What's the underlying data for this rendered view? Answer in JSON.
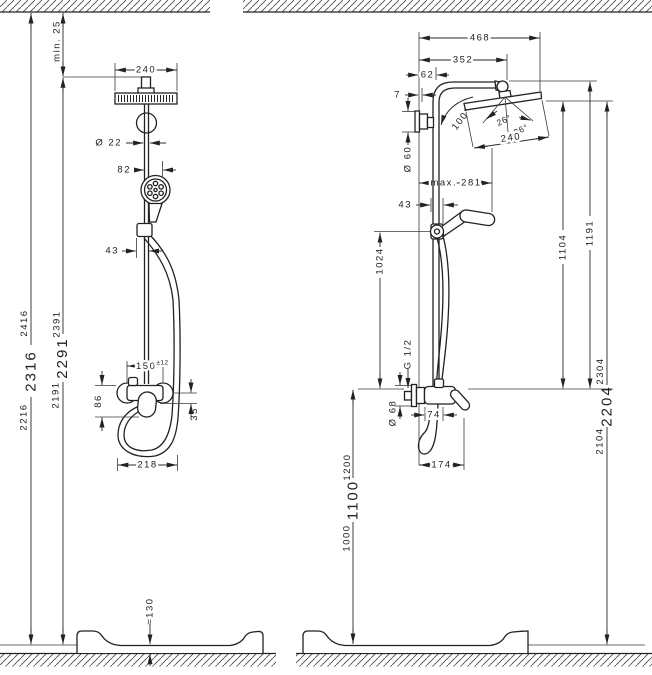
{
  "drawing": {
    "left_view": {
      "ceiling_min_clearance": "min. 25",
      "head_width": "240",
      "pipe_diameter": "Ø 22",
      "handshower_offset": "82",
      "holder_offset": "43",
      "connection_spacing": "150",
      "connection_tolerance": "±12",
      "mixer_height": "86",
      "outlet_offset": "35",
      "hose_loop_width": "218",
      "tray_height": "≈130",
      "height_a_low": "2216",
      "height_a_mid": "2316",
      "height_a_high": "2416",
      "height_b_low": "2191",
      "height_b_mid": "2291",
      "height_b_high": "2391"
    },
    "right_view": {
      "total_reach": "468",
      "arm_reach": "352",
      "wall_to_pipe": "62",
      "plate_offset": "7",
      "pivot_angle": "100°",
      "tilt_angle_1": "26°",
      "tilt_angle_2": "26°",
      "head_length": "240",
      "plate_diameter": "Ø 60",
      "handshower_reach": "max. 281",
      "holder_offset": "43",
      "holder_height": "1024",
      "head_height_above_mixer": "1104",
      "arm_height_above_mixer": "1191",
      "thread": "G 1/2",
      "escutcheon_diameter": "Ø 68",
      "mixer_width": "74",
      "hose_loop_width": "174",
      "mixer_height_low": "1000",
      "mixer_height_mid": "1100",
      "mixer_height_high": "1200",
      "total_height_low": "2104",
      "total_height_mid": "2204",
      "total_height_high": "2304"
    }
  }
}
